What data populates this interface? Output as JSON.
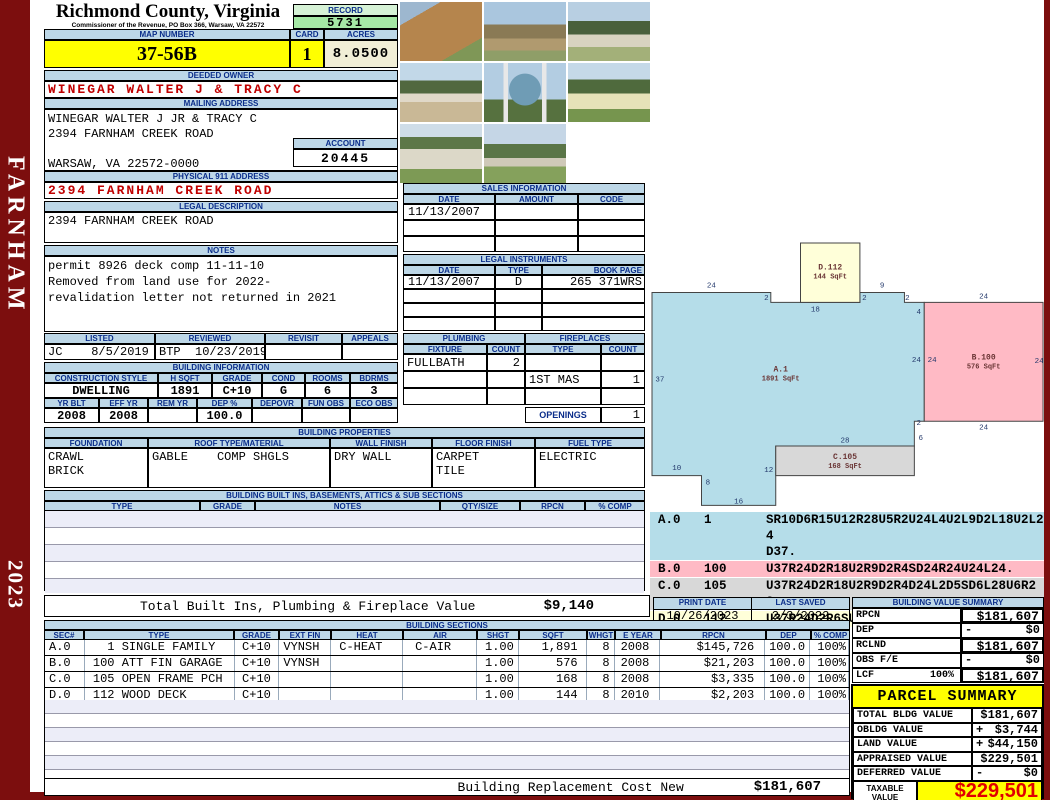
{
  "frame": {
    "district": "FARNHAM",
    "year": "2023"
  },
  "header": {
    "title": "Richmond County, Virginia",
    "subtitle": "Commissioner of the Revenue, PO Box 366, Warsaw, VA 22572",
    "record_label": "RECORD",
    "record_value": "5731",
    "map_label": "MAP NUMBER",
    "map_value": "37-56B",
    "card_label": "CARD",
    "card_value": "1",
    "acres_label": "ACRES",
    "acres_value": "8.0500"
  },
  "owner": {
    "header": "DEEDED OWNER",
    "name": "WINEGAR WALTER J & TRACY C"
  },
  "mailing": {
    "header": "MAILING ADDRESS",
    "lines": [
      "WINEGAR WALTER J JR & TRACY C",
      "2394 FARNHAM CREEK ROAD",
      "",
      "WARSAW, VA 22572-0000"
    ],
    "account_label": "ACCOUNT",
    "account_value": "20445"
  },
  "physical": {
    "header": "PHYSICAL 911 ADDRESS",
    "value": "2394 FARNHAM CREEK ROAD"
  },
  "legal": {
    "header": "LEGAL DESCRIPTION",
    "value": "2394 FARNHAM CREEK ROAD"
  },
  "notes": {
    "header": "NOTES",
    "lines": [
      "permit 8926 deck comp 11-11-10",
      "Removed from land use for 2022-",
      "revalidation letter not returned in 2021"
    ]
  },
  "review": {
    "headers": [
      "LISTED",
      "REVIEWED",
      "REVISIT",
      "APPEALS"
    ],
    "values": [
      "JC    8/5/2019",
      "BTP  10/23/2019",
      "",
      ""
    ]
  },
  "building_info": {
    "header": "BUILDING INFORMATION",
    "row1_headers": [
      "CONSTRUCTION STYLE",
      "H SQFT",
      "GRADE",
      "COND",
      "ROOMS",
      "BDRMS"
    ],
    "row1_values": [
      "DWELLING",
      "1891",
      "C+10",
      "G",
      "6",
      "3"
    ],
    "row2_headers": [
      "YR BLT",
      "EFF YR",
      "REM YR",
      "DEP %",
      "DEPOVR",
      "FUN OBS",
      "ECO OBS"
    ],
    "row2_values": [
      "2008",
      "2008",
      "",
      "100.0",
      "",
      "",
      ""
    ]
  },
  "properties": {
    "header": "BUILDING PROPERTIES",
    "col_headers": [
      "FOUNDATION",
      "ROOF TYPE/MATERIAL",
      "WALL FINISH",
      "FLOOR FINISH",
      "FUEL TYPE"
    ],
    "foundation": "CRAWL\nBRICK",
    "roof_type": "GABLE",
    "roof_material": "COMP SHGLS",
    "wall": "DRY WALL",
    "floor": "CARPET\nTILE",
    "fuel": "ELECTRIC"
  },
  "built_ins": {
    "header": "BUILDING BUILT INS, BASEMENTS, ATTICS & SUB SECTIONS",
    "col_headers": [
      "TYPE",
      "GRADE",
      "NOTES",
      "QTY/SIZE",
      "RPCN",
      "% COMP"
    ]
  },
  "sales": {
    "header": "SALES INFORMATION",
    "col_headers": [
      "DATE",
      "AMOUNT",
      "CODE"
    ],
    "rows": [
      [
        "11/13/2007",
        "",
        ""
      ],
      [
        "",
        "",
        ""
      ],
      [
        "",
        "",
        ""
      ]
    ]
  },
  "instruments": {
    "header": "LEGAL INSTRUMENTS",
    "col_headers": [
      "DATE",
      "TYPE",
      "BOOK PAGE"
    ],
    "rows": [
      [
        "11/13/2007",
        "D",
        "265 371WRS"
      ],
      [
        "",
        "",
        ""
      ],
      [
        "",
        "",
        ""
      ],
      [
        "",
        "",
        ""
      ]
    ]
  },
  "plumbing": {
    "header": "PLUMBING",
    "col_headers": [
      "FIXTURE",
      "COUNT"
    ],
    "rows": [
      [
        "FULLBATH",
        "2"
      ],
      [
        "",
        ""
      ],
      [
        "",
        ""
      ]
    ]
  },
  "fireplaces": {
    "header": "FIREPLACES",
    "col_headers": [
      "TYPE",
      "COUNT"
    ],
    "rows": [
      [
        "",
        ""
      ],
      [
        "1ST MAS",
        "1"
      ],
      [
        "",
        ""
      ]
    ],
    "openings_label": "OPENINGS",
    "openings_value": "1"
  },
  "photos": {
    "items": [
      {
        "name": "framing-structure-photo"
      },
      {
        "name": "house-under-construction-photo"
      },
      {
        "name": "white-house-photo"
      },
      {
        "name": "house-and-field-photo"
      },
      {
        "name": "property-sign-photo"
      },
      {
        "name": "yellow-shed-photo"
      },
      {
        "name": "garage-photo"
      },
      {
        "name": "house-with-lawn-photo"
      }
    ]
  },
  "sketch": {
    "shapes": [
      {
        "id": "A",
        "label": "A.1",
        "sqft": "1891 SqFt",
        "fill": "#b5dde9",
        "points": "0,47 10,47 10,53 25,53 25,41 53,41 53,36 55,36 55,12 51,12 51,10 42,10 42,12 24,12 24,10 0,10",
        "lx": 26,
        "ly": 26
      },
      {
        "id": "B",
        "label": "B.100",
        "sqft": "576 SqFt",
        "fill": "#ffbac5",
        "points": "55,12 79,12 79,36 55,36",
        "lx": 67,
        "ly": 23.5
      },
      {
        "id": "C",
        "label": "C.105",
        "sqft": "168 SqFt",
        "fill": "#d8d8d8",
        "points": "25,41 53,41 53,47 25,47",
        "lx": 39,
        "ly": 43.6
      },
      {
        "id": "D",
        "label": "D.112",
        "sqft": "144 SqFt",
        "fill": "#ffffd9",
        "points": "30,0 42,0 42,12 30,12",
        "lx": 36,
        "ly": 5.4
      }
    ],
    "dims": [
      [
        "24",
        12,
        9.0
      ],
      [
        "2",
        23.1,
        11.5
      ],
      [
        "18",
        33,
        13.8
      ],
      [
        "2",
        42.9,
        11.5
      ],
      [
        "9",
        46.5,
        9.0
      ],
      [
        "2",
        51.6,
        11.5
      ],
      [
        "4",
        53.9,
        14.3
      ],
      [
        "24",
        53.4,
        24
      ],
      [
        "24",
        56.6,
        24
      ],
      [
        "37",
        1.6,
        28
      ],
      [
        "2",
        53.9,
        36.8
      ],
      [
        "6",
        54.3,
        39.8
      ],
      [
        "28",
        39,
        40.3
      ],
      [
        "12",
        23.6,
        46.3
      ],
      [
        "10",
        5,
        45.9
      ],
      [
        "8",
        11.3,
        48.8
      ],
      [
        "16",
        17.5,
        52.6
      ],
      [
        "24",
        67,
        11.2
      ],
      [
        "24",
        78.2,
        24.2
      ],
      [
        "24",
        67,
        37.7
      ]
    ]
  },
  "codes": {
    "rows": [
      {
        "id": "A.0",
        "num": "1",
        "code": "SR10D6R15U12R28U5R2U24L4U2L9D2L18U2L24\nD37.",
        "bg": "#b5dde9"
      },
      {
        "id": "B.0",
        "num": "100",
        "code": "U37R24D2R18U2R9D2R4SD24R24U24L24.",
        "bg": "#ffbac5"
      },
      {
        "id": "C.0",
        "num": "105",
        "code": "U37R24D2R18U2R9D2R4D24L2D5SD6L28U6R28.",
        "bg": "#d8d8d8"
      },
      {
        "id": "D.0",
        "num": "112",
        "code": "U37R24D2R6SU12R12D12L12.",
        "bg": "#ffffd9"
      }
    ]
  },
  "totals": {
    "built_ins_label": "Total Built Ins, Plumbing & Fireplace Value",
    "built_ins_value": "$9,140",
    "replacement_label": "Building Replacement Cost New",
    "replacement_value": "$181,607"
  },
  "print": {
    "print_label": "PRINT DATE",
    "print_value": "10/26/2023",
    "saved_label": "LAST SAVED",
    "saved_value": "2/3/2022"
  },
  "sections": {
    "header": "BUILDING SECTIONS",
    "col_headers": [
      "SEC#",
      "TYPE",
      "GRADE",
      "EXT FIN",
      "HEAT",
      "AIR",
      "SHGT",
      "SQFT",
      "WHGT",
      "E YEAR",
      "RPCN",
      "DEP",
      "% COMP"
    ],
    "rows": [
      {
        "cells": [
          "A.0",
          "  1 SINGLE FAMILY",
          "C+10",
          "VYNSH",
          "C-HEAT",
          "C-AIR",
          "1.00",
          "1,891",
          "8",
          "2008",
          "$145,726",
          "100.0",
          "100%"
        ]
      },
      {
        "cells": [
          "B.0",
          "100 ATT FIN GARAGE",
          "C+10",
          "VYNSH",
          "",
          "",
          "1.00",
          "576",
          "8",
          "2008",
          "$21,203",
          "100.0",
          "100%"
        ]
      },
      {
        "cells": [
          "C.0",
          "105 OPEN FRAME PCH",
          "C+10",
          "",
          "",
          "",
          "1.00",
          "168",
          "8",
          "2008",
          "$3,335",
          "100.0",
          "100%"
        ]
      },
      {
        "cells": [
          "D.0",
          "112 WOOD DECK",
          "C+10",
          "",
          "",
          "",
          "1.00",
          "144",
          "8",
          "2010",
          "$2,203",
          "100.0",
          "100%"
        ]
      }
    ]
  },
  "value_summary": {
    "header": "BUILDING VALUE SUMMARY",
    "rows": [
      {
        "label": "RPCN",
        "pct": "",
        "sign": "",
        "value": "$181,607"
      },
      {
        "label": "DEP",
        "pct": "",
        "sign": "-",
        "value": "$0"
      },
      {
        "label": "RCLND",
        "pct": "",
        "sign": "",
        "value": "$181,607"
      },
      {
        "label": "OBS F/E",
        "pct": "",
        "sign": "-",
        "value": "$0"
      },
      {
        "label": "LCF",
        "pct": "100%",
        "sign": "",
        "value": "$181,607"
      }
    ]
  },
  "parcel": {
    "header": "PARCEL SUMMARY",
    "rows": [
      {
        "label": "TOTAL BLDG VALUE",
        "sign": "",
        "value": "$181,607"
      },
      {
        "label": "OBLDG VALUE",
        "sign": "+",
        "value": "$3,744"
      },
      {
        "label": "LAND VALUE",
        "sign": "+",
        "value": "$44,150"
      },
      {
        "label": "APPRAISED VALUE",
        "sign": "",
        "value": "$229,501"
      },
      {
        "label": "DEFERRED VALUE",
        "sign": "-",
        "value": "$0"
      }
    ],
    "taxable_label": "TAXABLE VALUE",
    "taxable_value": "$229,501"
  }
}
